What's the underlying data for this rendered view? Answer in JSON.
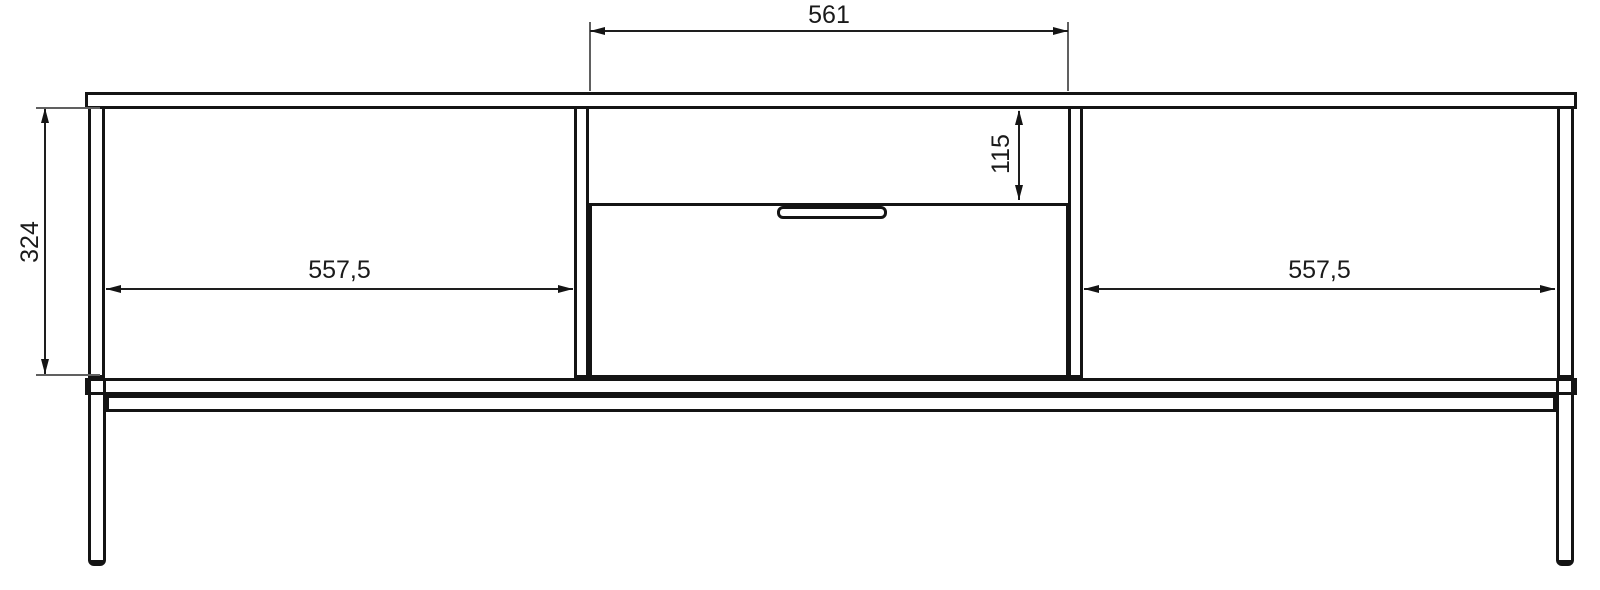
{
  "drawing": {
    "kind": "furniture-technical-drawing",
    "view": "front-elevation",
    "background_color": "#ffffff",
    "line_color": "#141414",
    "dimension_line_color": "#1e1e1e",
    "dimensions": {
      "middle_niche_width": {
        "label": "561",
        "orientation": "horizontal",
        "position": "top"
      },
      "body_height": {
        "label": "324",
        "orientation": "vertical",
        "position": "left"
      },
      "middle_niche_height": {
        "label": "115",
        "orientation": "vertical",
        "position": "middle-right-of-niche"
      },
      "left_niche_width": {
        "label": "557,5",
        "orientation": "horizontal",
        "position": "left-compartment"
      },
      "right_niche_width": {
        "label": "557,5",
        "orientation": "horizontal",
        "position": "right-compartment"
      }
    },
    "parts": {
      "top_panel": "top panel",
      "bottom_panel": "bottom panel",
      "left_side_panel": "left side panel",
      "right_side_panel": "right side panel",
      "left_partition": "left partition",
      "right_partition": "right partition",
      "drawer_front": "central drawer front",
      "drawer_handle": "recessed drawer handle",
      "frame_rail": "metal base frame rail",
      "left_leg": "left metal leg",
      "right_leg": "right metal leg"
    }
  }
}
